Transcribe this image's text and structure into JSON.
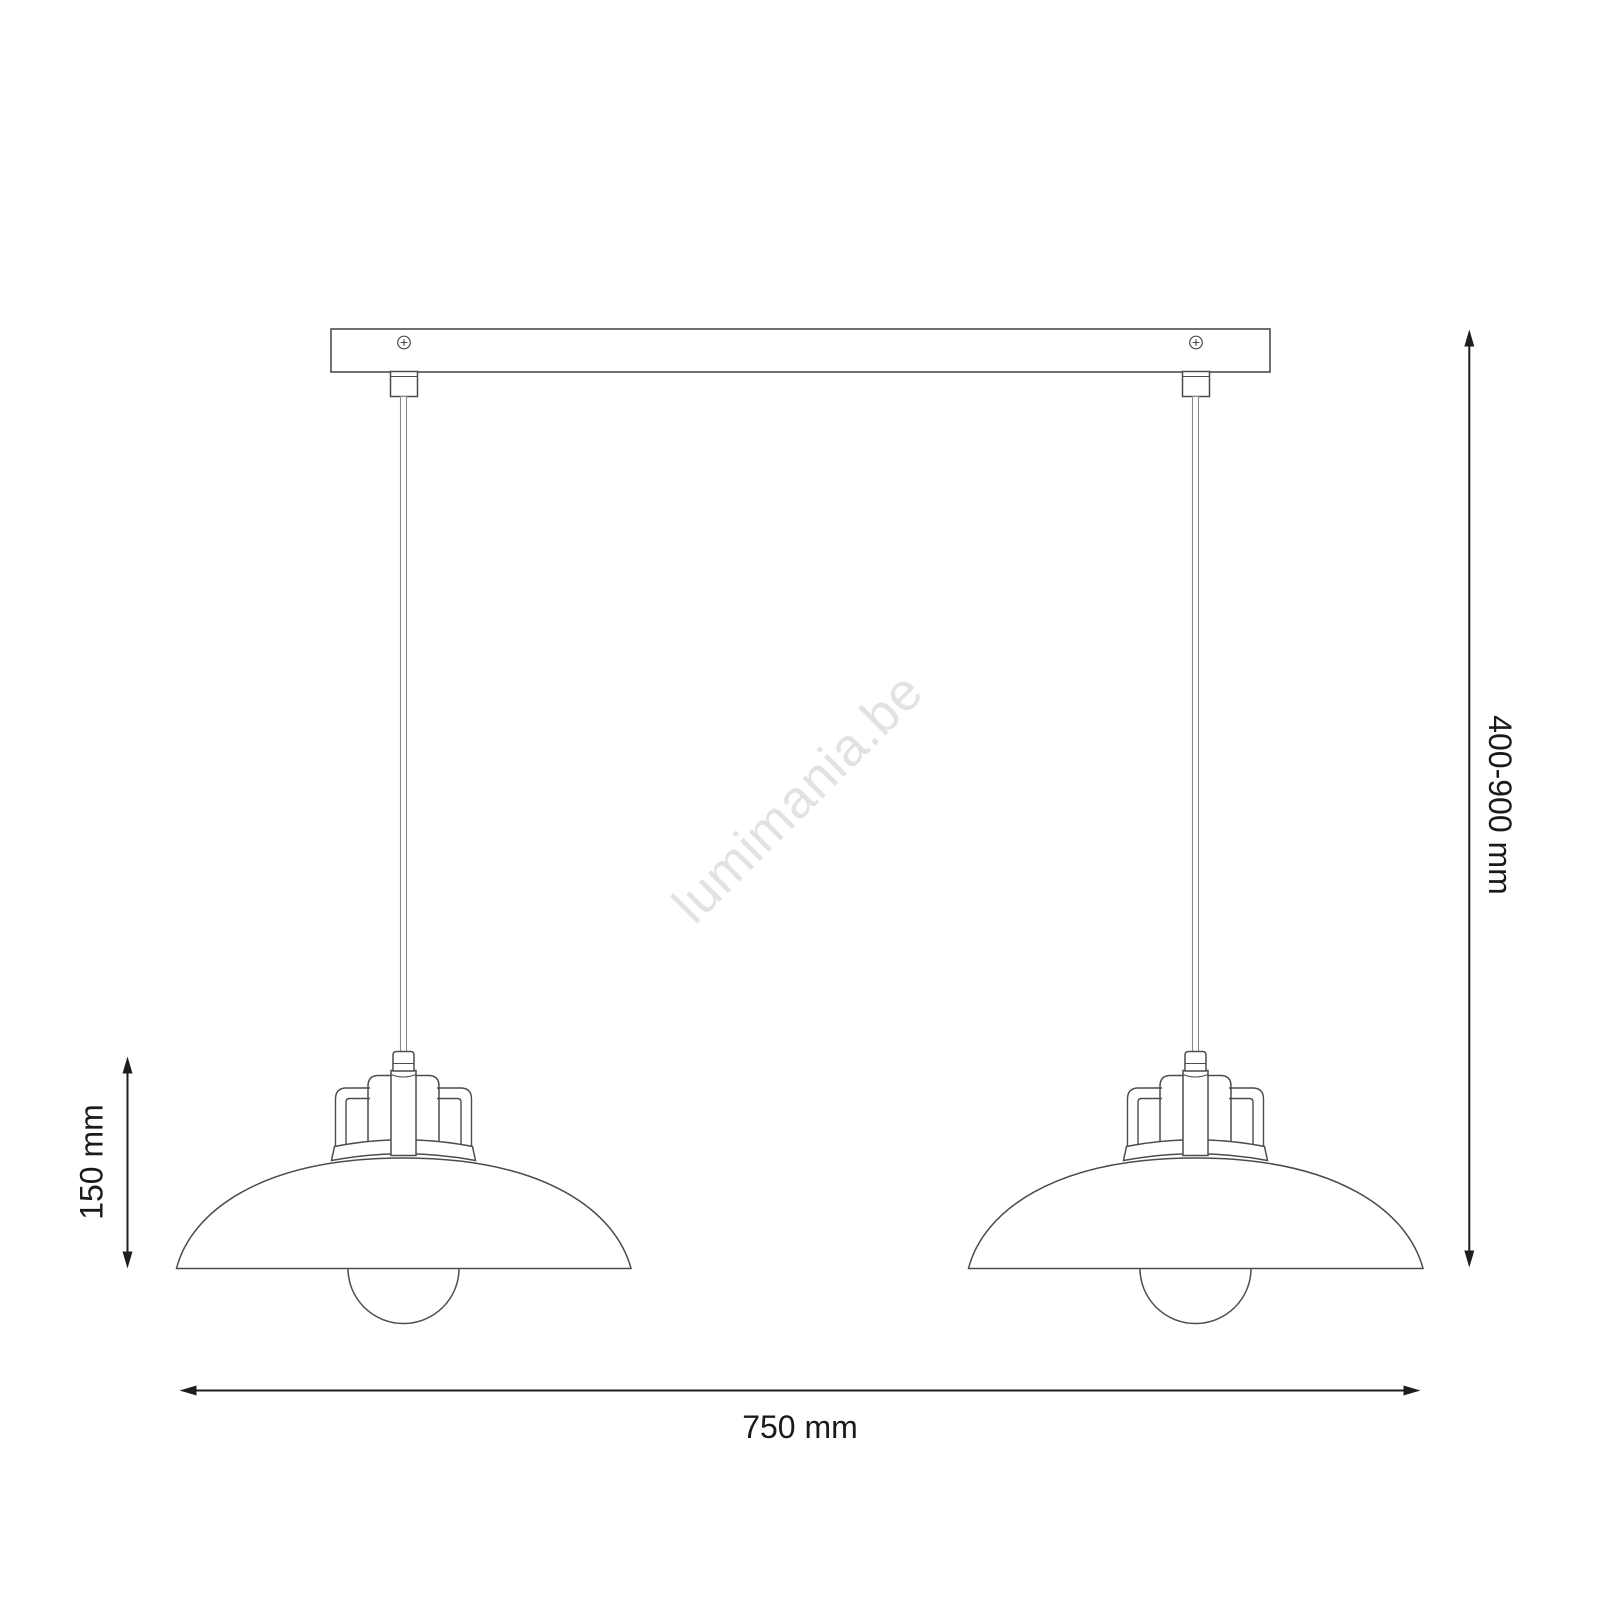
{
  "watermark": {
    "text": "lumimania.be",
    "color": "#e2e2e2",
    "rotation_deg": -45
  },
  "dimensions": {
    "suspension_height": {
      "label": "400-900 mm",
      "orientation": "vertical-right",
      "rotation_deg": 90
    },
    "shade_height": {
      "label": "150 mm",
      "orientation": "vertical-left",
      "rotation_deg": -90
    },
    "total_width": {
      "label": "750 mm",
      "orientation": "horizontal-bottom"
    }
  },
  "drawing": {
    "background_color": "#ffffff",
    "line_color": "#4c4c4c",
    "cord_color": "#8c8c8c",
    "dimension_color": "#1e1e1e",
    "lamp_count": 2
  }
}
